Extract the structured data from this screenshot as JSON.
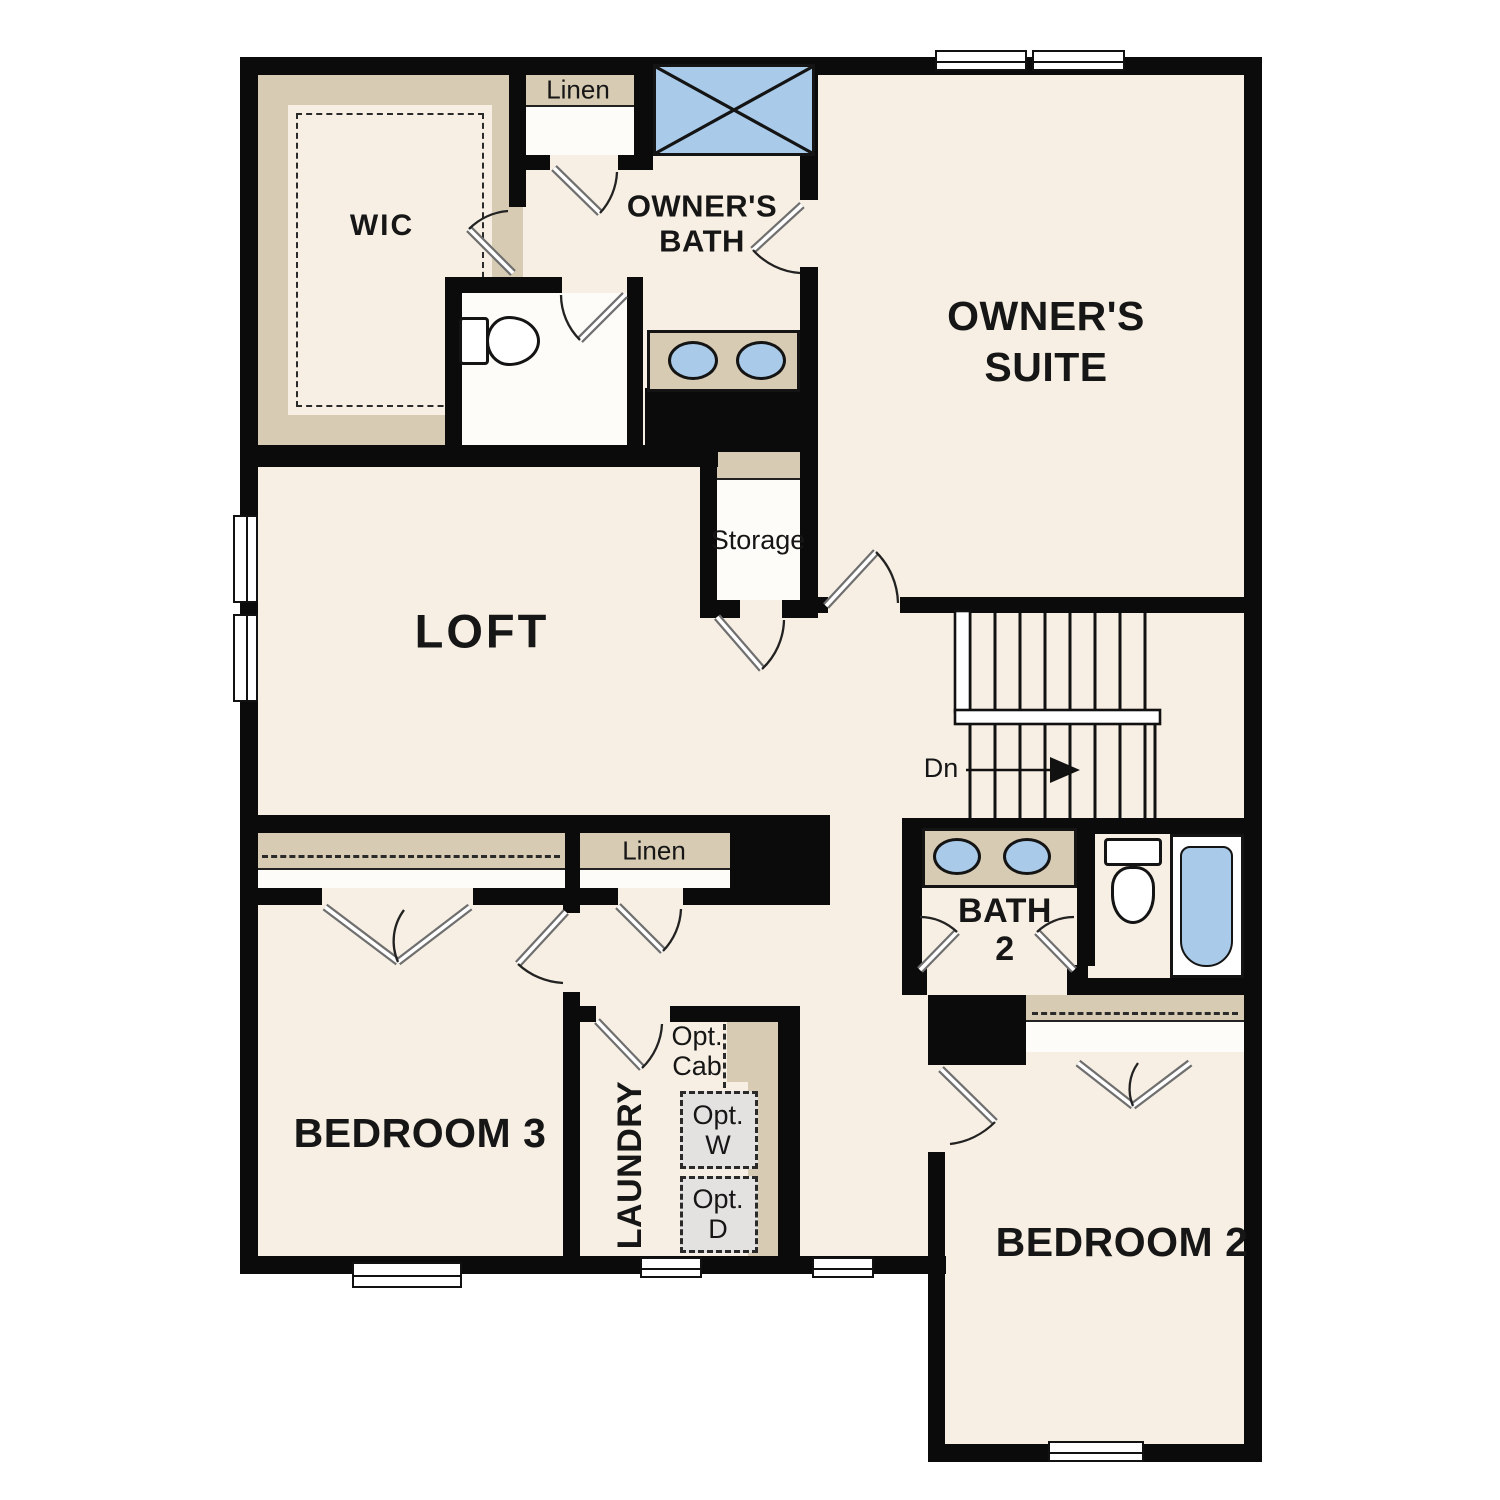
{
  "title": "Second Floor Plan",
  "rooms": {
    "wic": "WIC",
    "linen_top": "Linen",
    "owners_bath_l1": "OWNER'S",
    "owners_bath_l2": "BATH",
    "owners_suite_l1": "OWNER'S",
    "owners_suite_l2": "SUITE",
    "loft": "LOFT",
    "storage": "Storage",
    "stairs_down": "Dn",
    "bath2_l1": "BATH",
    "bath2_l2": "2",
    "linen_mid": "Linen",
    "bedroom3": "BEDROOM 3",
    "laundry": "LAUNDRY",
    "opt_cab_l1": "Opt.",
    "opt_cab_l2": "Cab",
    "opt_w_l1": "Opt.",
    "opt_w_l2": "W",
    "opt_d_l1": "Opt.",
    "opt_d_l2": "D",
    "bedroom2": "BEDROOM 2"
  },
  "icons": {
    "shower": "shower-icon",
    "toilet": "toilet-icon",
    "sink": "sink-icon",
    "bathtub": "bathtub-icon",
    "window": "window-icon",
    "door": "door-icon",
    "stairs": "staircase-icon",
    "down_arrow": "down-arrow-icon"
  },
  "colors": {
    "wall": "#0b0b0b",
    "floor": "#f7efe3",
    "closet": "#fdfcf9",
    "shelf": "#d7cbb3",
    "fixture": "#a9cbe9",
    "appliance": "#e3e2e0"
  }
}
